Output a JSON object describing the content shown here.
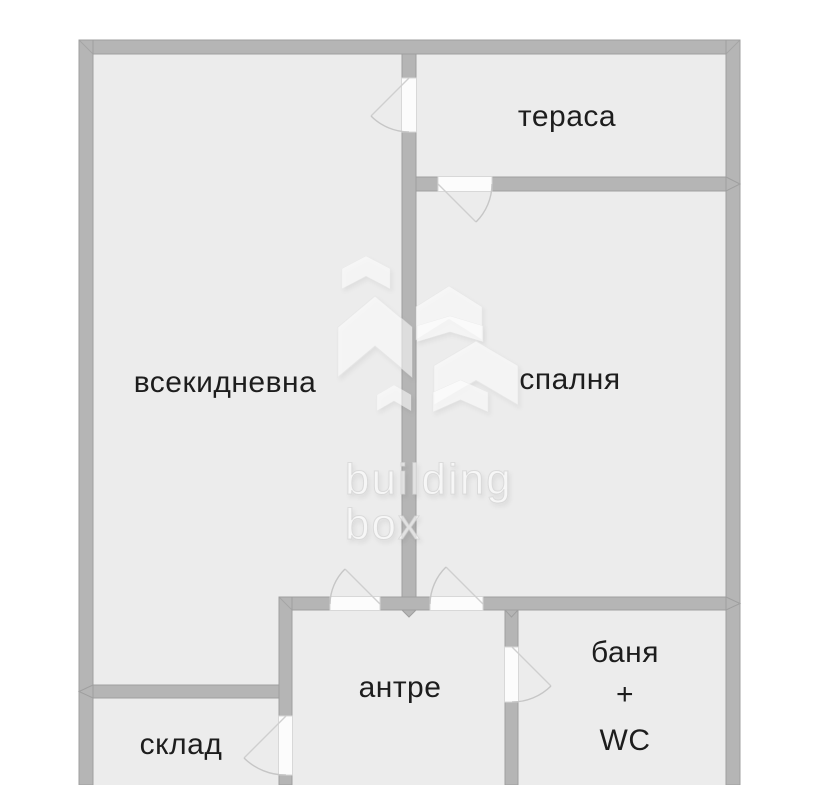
{
  "rooms": {
    "living": {
      "label": "всекидневна"
    },
    "terrace": {
      "label": "тераса"
    },
    "bedroom": {
      "label": "спалня"
    },
    "hallway": {
      "label": "антре"
    },
    "bathroom": {
      "lines": [
        "баня",
        "+",
        "WC"
      ]
    },
    "storage": {
      "label": "склад"
    }
  },
  "watermark": {
    "brand_line1": "building",
    "brand_line2": "box"
  },
  "colors": {
    "wall": "#b5b5b5",
    "wall_outline": "#9f9f9f",
    "floor": "#ececec",
    "door_leaf": "#fcfcfc",
    "door_swing": "#c6c6c6",
    "label_text": "#1d1d1d"
  }
}
